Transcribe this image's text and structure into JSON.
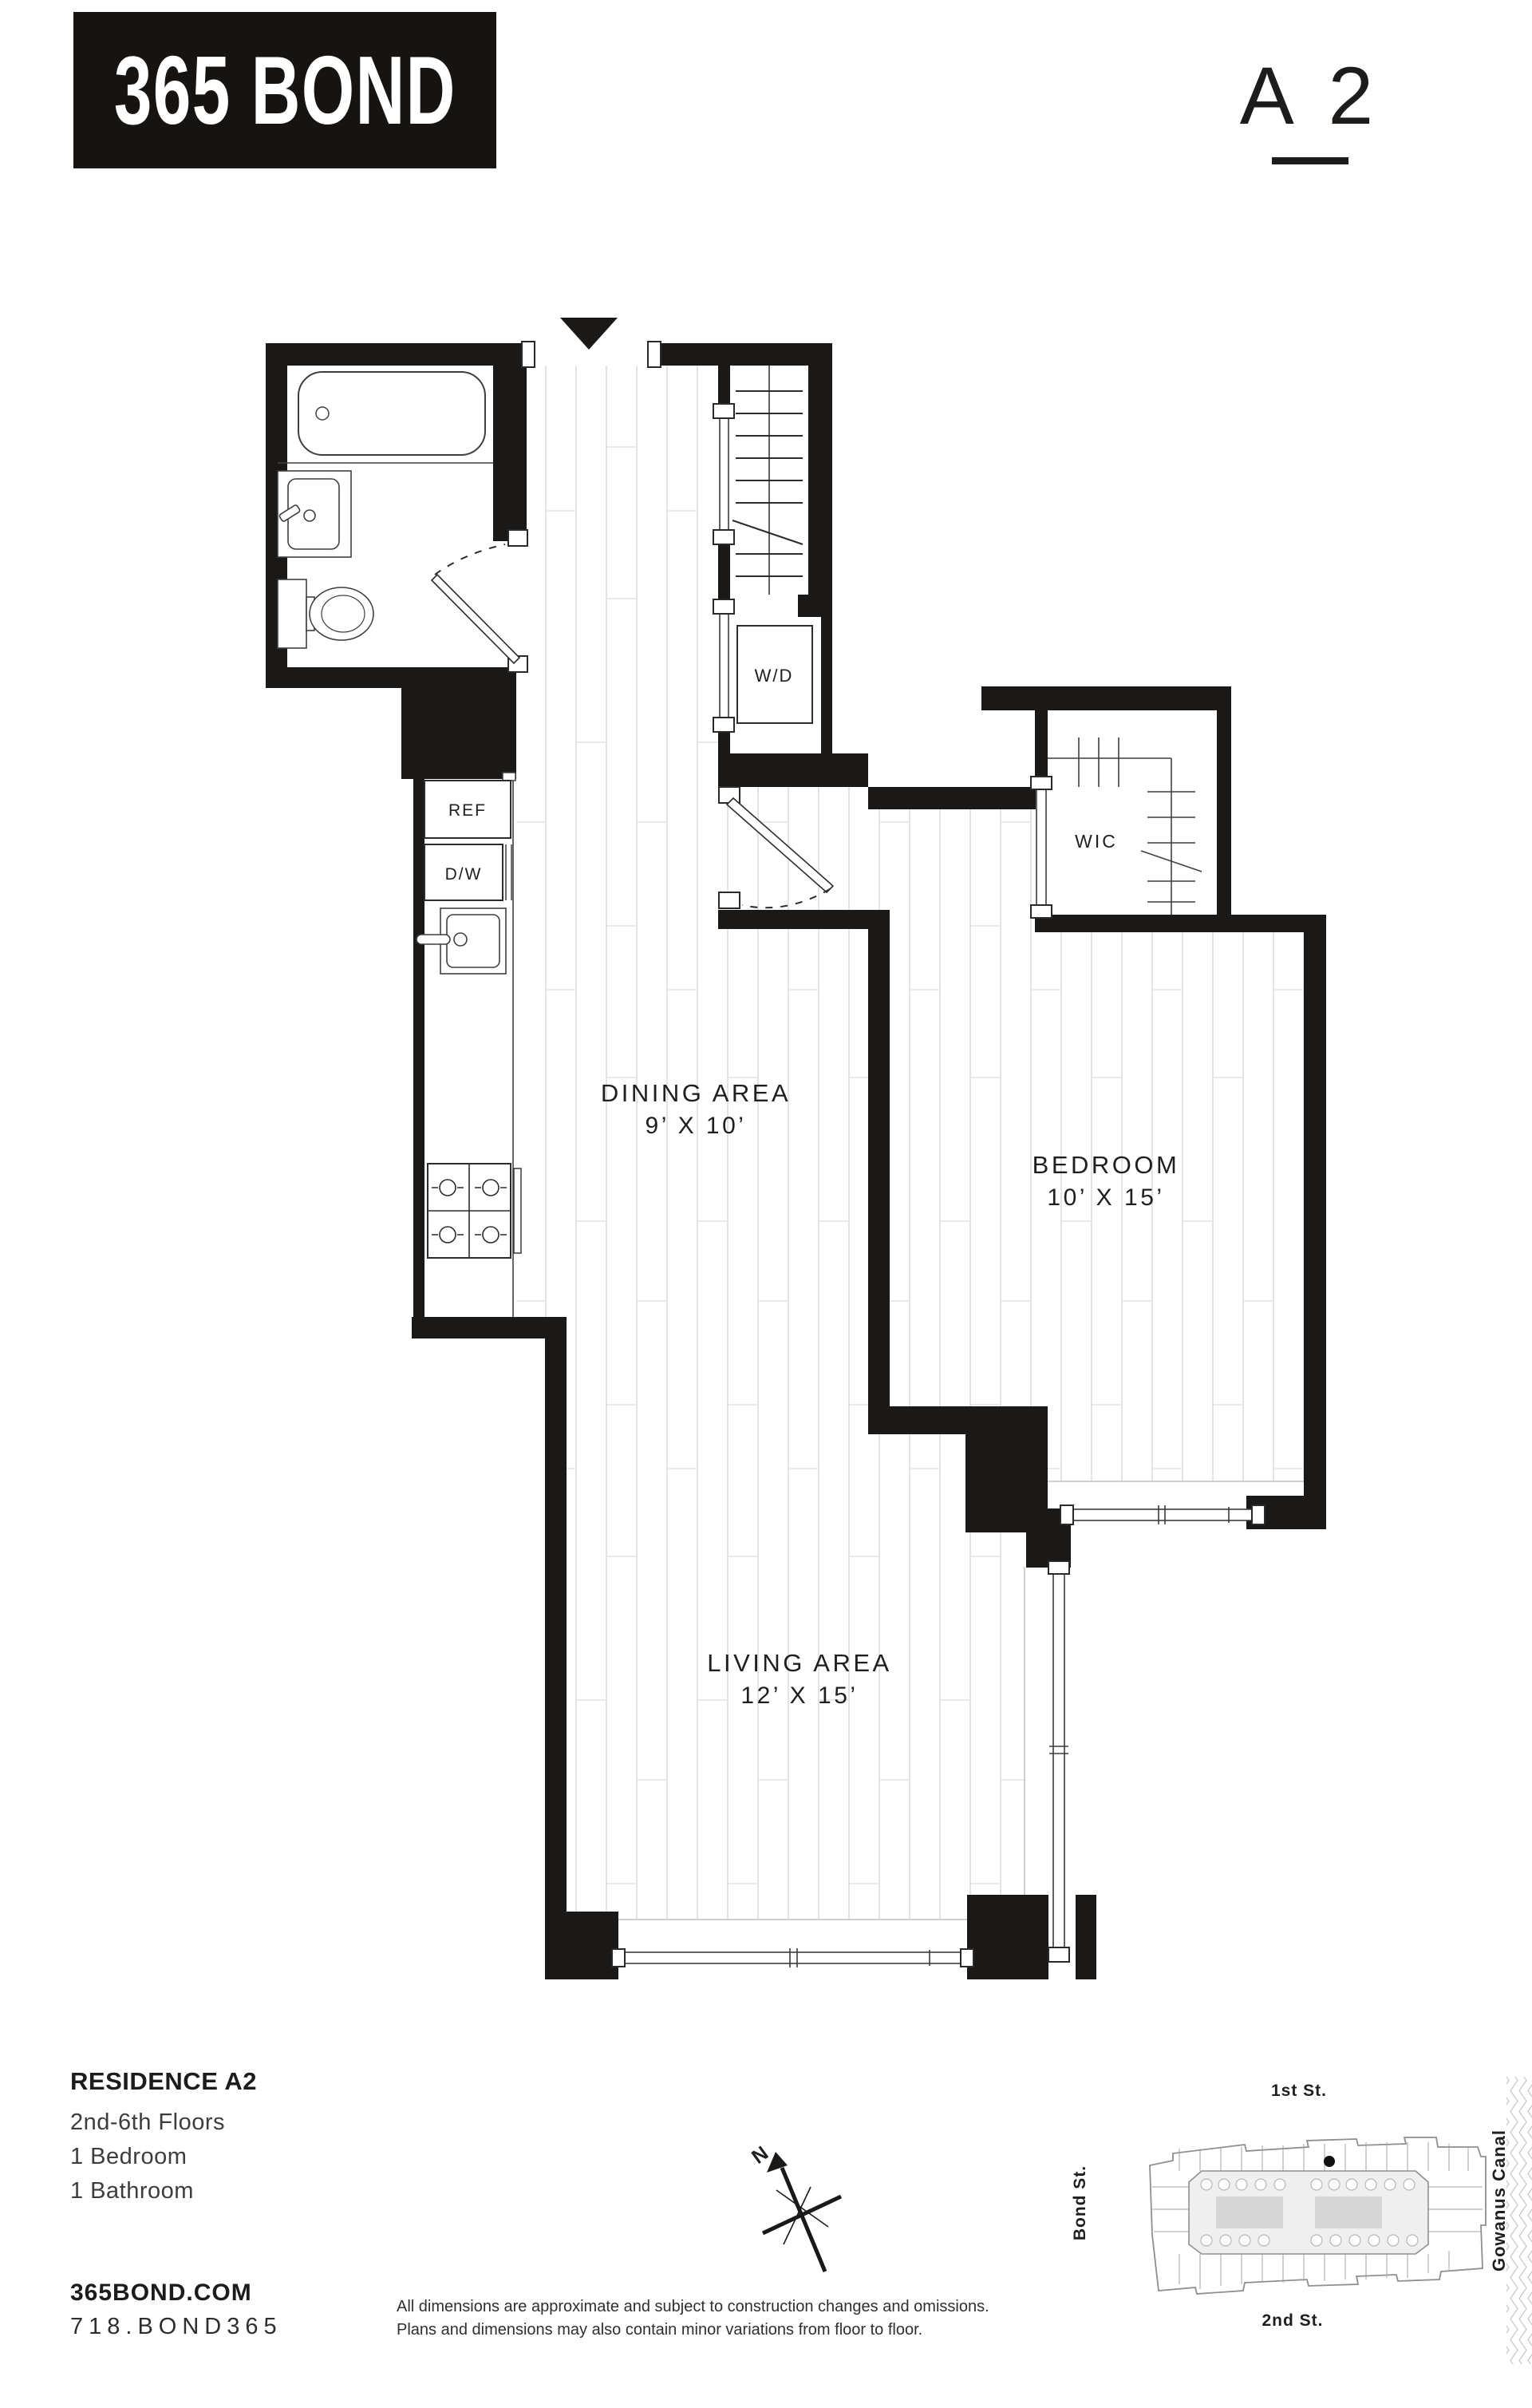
{
  "header": {
    "logo": "365 BOND",
    "unit": "A 2"
  },
  "plan": {
    "rooms": [
      {
        "name": "DINING AREA",
        "dims": "9’ X 10’"
      },
      {
        "name": "BEDROOM",
        "dims": "10’ X 15’"
      },
      {
        "name": "LIVING AREA",
        "dims": "12’ X 15’"
      }
    ],
    "fixtures": {
      "washer_dryer": "W/D",
      "walk_in_closet": "WIC",
      "refrigerator": "REF",
      "dishwasher": "D/W"
    },
    "compass_north": "N"
  },
  "site_map": {
    "north": "1st St.",
    "south": "2nd St.",
    "west": "Bond St.",
    "east": "Gowanus Canal"
  },
  "info": {
    "residence": "RESIDENCE A2",
    "floors": "2nd-6th Floors",
    "bedrooms": "1 Bedroom",
    "bathrooms": "1 Bathroom"
  },
  "contact": {
    "website": "365BOND.COM",
    "phone": "718.BOND365"
  },
  "disclaimer": {
    "line1": "All dimensions are approximate and subject to construction changes and omissions.",
    "line2": "Plans and dimensions may also contain minor variations from floor to floor."
  },
  "colors": {
    "wall": "#1b1917",
    "floor_line": "#dedede"
  }
}
